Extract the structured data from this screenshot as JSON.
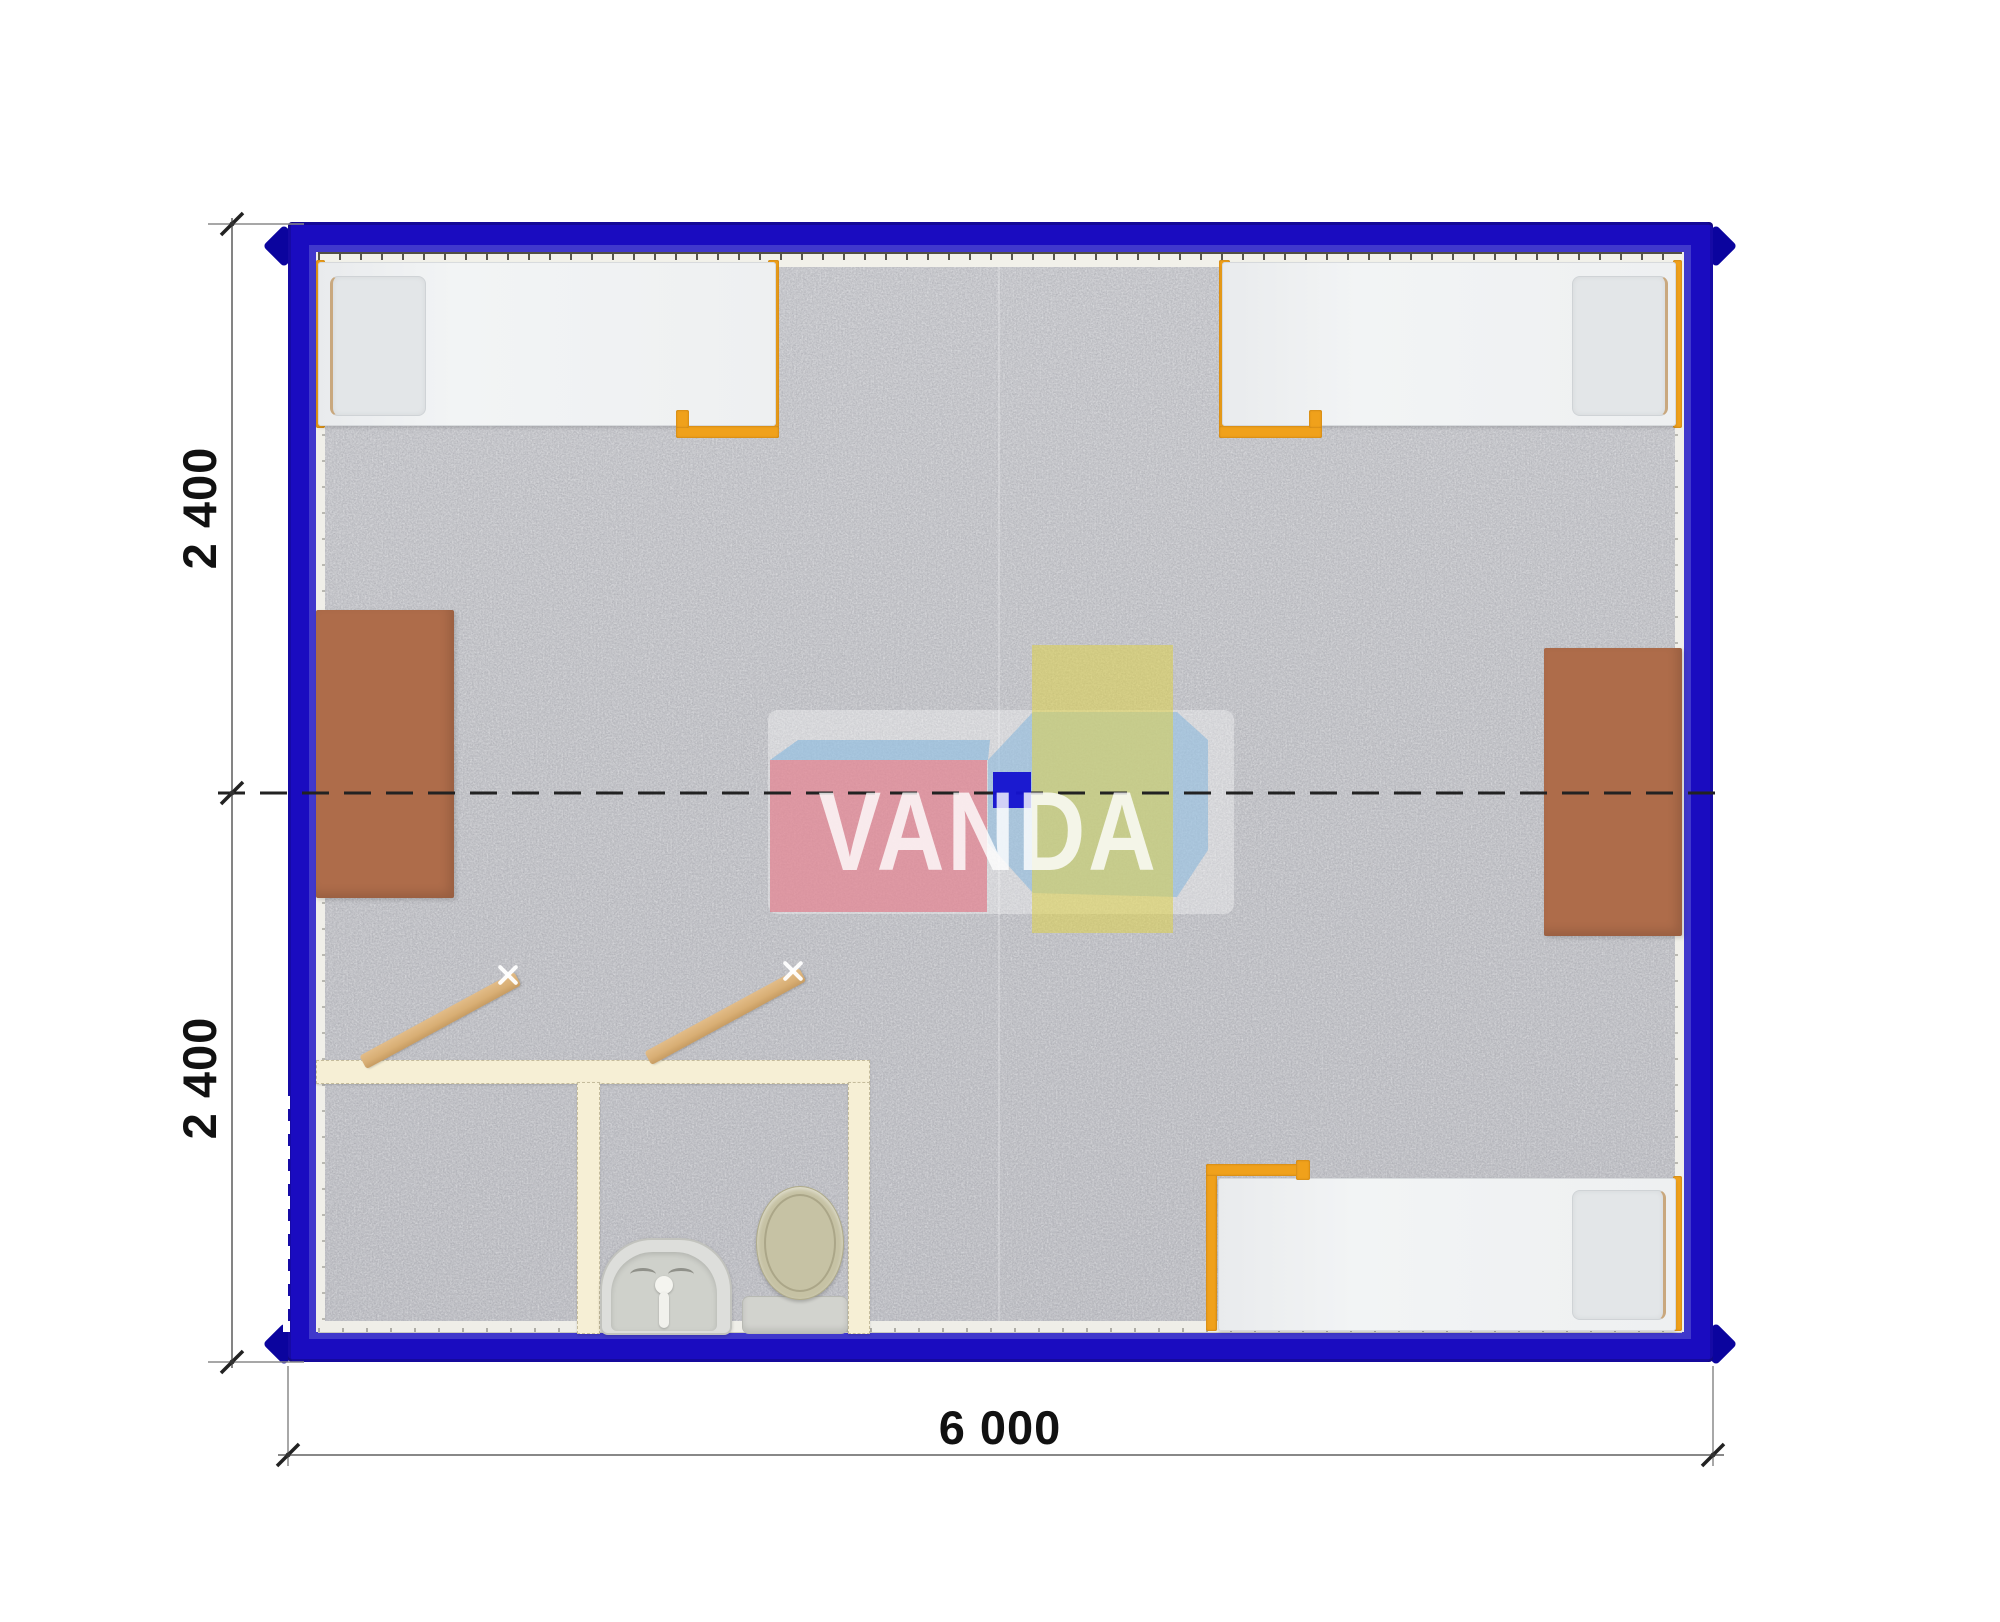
{
  "dimensions": {
    "left_top": "2 400",
    "left_bottom": "2 400",
    "bottom": "6 000"
  },
  "watermark": {
    "brand_text": "VANDA"
  },
  "colors": {
    "wall_blue": "#1a0cc0",
    "wall_blue_light": "#4038cc",
    "corner_casting": "#0b049e",
    "floor_gray": "#c6c7cb",
    "mattress_white": "#eef0f1",
    "pillow_gray": "#e3e6e8",
    "frame_orange": "#f0a11b",
    "desk_brown": "#ae6c4a",
    "partition_cream": "#f6efd5",
    "door_wood": "#d8ae74",
    "toilet_beige": "#c6c2a4",
    "ceramic_white": "#dddedb",
    "centerline_dark": "#222222",
    "dimension_line": "#777777",
    "dimension_text": "#111111",
    "watermark_pink": "#e07080",
    "watermark_yellow": "#ded44b",
    "watermark_light_blue": "#7cb2dc",
    "watermark_deep_blue": "#1513cf"
  },
  "plan": {
    "type": "container-cabin-floor-plan",
    "elements": [
      "bed-top-left",
      "bed-top-right",
      "bed-bottom-right",
      "desk-left",
      "desk-right",
      "sanitary-partition",
      "partition-door-left",
      "partition-door-right",
      "washbasin",
      "toilet",
      "heater-strip-top",
      "baseboard-strip-bottom",
      "wall-door-marker-left",
      "center-axis-line"
    ]
  }
}
